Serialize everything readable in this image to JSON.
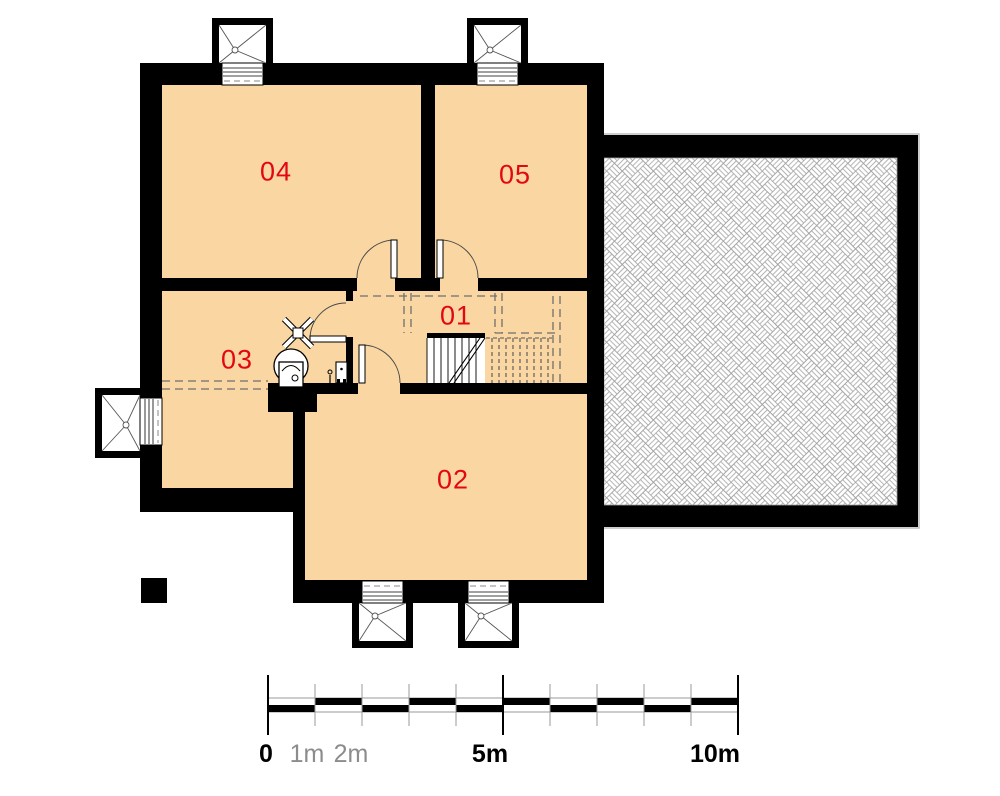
{
  "colors": {
    "wall_color": "#000000",
    "room_fill": "#f9d6a2",
    "label_color": "#e30613",
    "hatch_line": "#a0a0a0",
    "dash_color": "#6f6f6f",
    "scale_muted": "#8c8c8c"
  },
  "rooms": [
    {
      "label": "01"
    },
    {
      "label": "02"
    },
    {
      "label": "03"
    },
    {
      "label": "04"
    },
    {
      "label": "05"
    }
  ],
  "scale_bar": {
    "labels": [
      "0",
      "1m",
      "2m",
      "5m",
      "10m"
    ],
    "total_meters": 10
  },
  "symbols": {
    "window_well": "window-well",
    "window": "window",
    "door": "door-swing",
    "stairs": "stairs",
    "boiler": "boiler",
    "floor_drain": "floor-drain",
    "unexcavated_hatch": "basketweave-hatch",
    "scale_bar": "scale-bar"
  }
}
